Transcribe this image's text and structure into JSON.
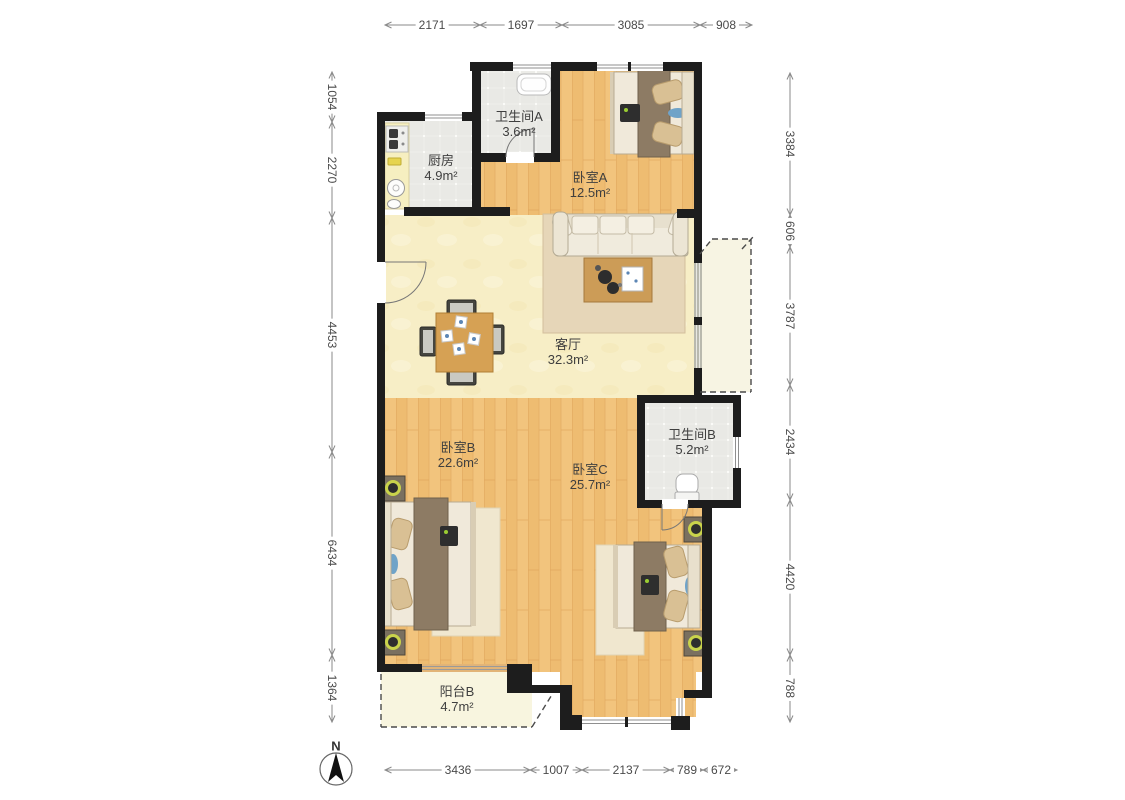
{
  "page": {
    "type": "apartment-floor-plan",
    "background": "#ffffff"
  },
  "rooms": [
    {
      "id": "kitchen",
      "name": "厨房",
      "area": "4.9m²"
    },
    {
      "id": "bathroom_a",
      "name": "卫生间A",
      "area": "3.6m²"
    },
    {
      "id": "bedroom_a",
      "name": "卧室A",
      "area": "12.5m²"
    },
    {
      "id": "living_room",
      "name": "客厅",
      "area": "32.3m²"
    },
    {
      "id": "bedroom_b",
      "name": "卧室B",
      "area": "22.6m²"
    },
    {
      "id": "bedroom_c",
      "name": "卧室C",
      "area": "25.7m²"
    },
    {
      "id": "bathroom_b",
      "name": "卫生间B",
      "area": "5.2m²"
    },
    {
      "id": "balcony_b",
      "name": "阳台B",
      "area": "4.7m²"
    }
  ],
  "dimensions": {
    "top": [
      "2171",
      "1697",
      "3085",
      "908"
    ],
    "left": [
      "1054",
      "2270",
      "4453",
      "6434",
      "1364"
    ],
    "right": [
      "3384",
      "606",
      "3787",
      "2434",
      "4420",
      "788"
    ],
    "bottom": [
      "3436",
      "1007",
      "2137",
      "789",
      "672"
    ]
  },
  "compass": {
    "north_label": "N"
  },
  "colors": {
    "wall": "#1d1d1d",
    "wood_floor": "#f2c47d",
    "living_floor": "#f7eec6",
    "tile_floor": "#e9e9e5",
    "balcony_floor": "#f8f5df",
    "dimension_line": "#8a8a8a",
    "label_text": "#3f3f3f",
    "accent_blue": "#6fa3c8",
    "lamp_ring": "#c9d34b",
    "blanket_brown": "#8d7b64",
    "rug_tan": "#e6d6b8"
  }
}
